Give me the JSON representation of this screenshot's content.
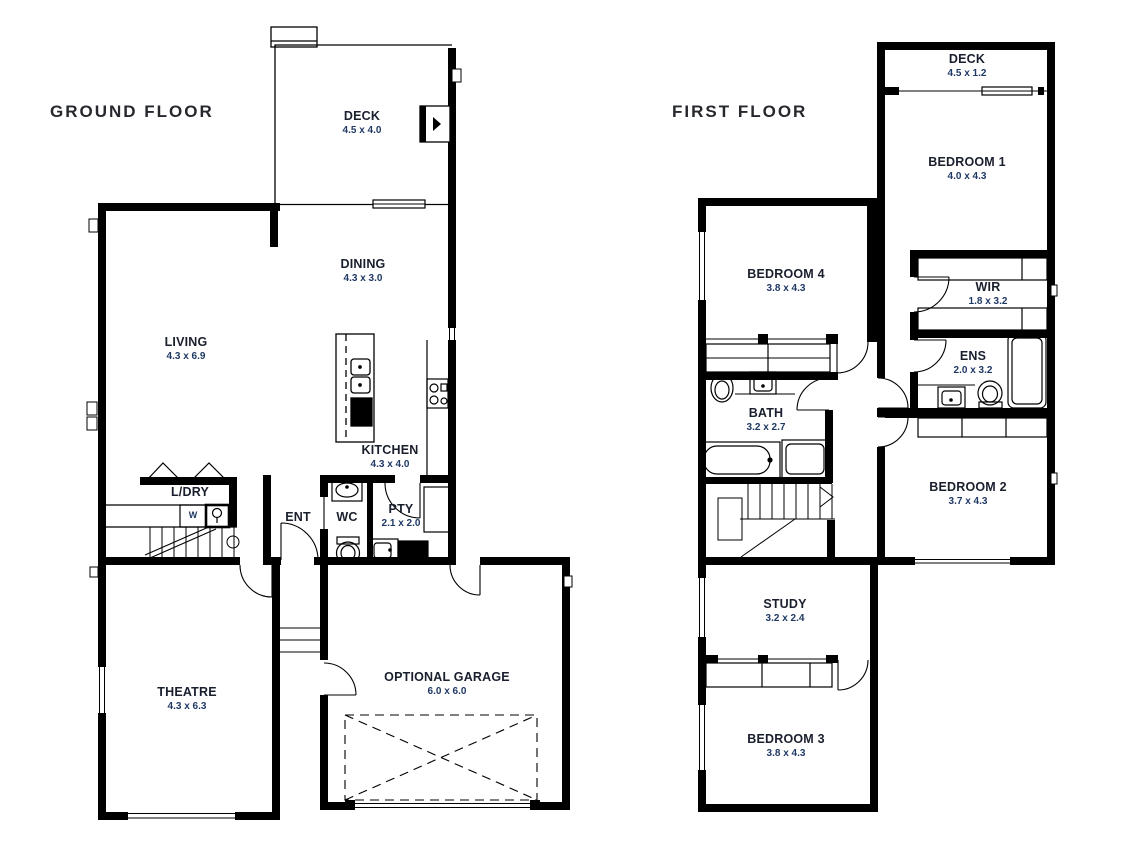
{
  "document_type": "house-floor-plan",
  "colors": {
    "wall": "#000000",
    "background": "#ffffff",
    "room_name_text": "#1a1f2e",
    "room_dims_text": "#1f3864",
    "title_text": "#26282e"
  },
  "floors": [
    {
      "id": "ground",
      "title": "GROUND FLOOR",
      "washer_label": "W",
      "rooms": [
        {
          "name": "DECK",
          "dims": "4.5 x 4.0"
        },
        {
          "name": "DINING",
          "dims": "4.3 x 3.0"
        },
        {
          "name": "LIVING",
          "dims": "4.3 x 6.9"
        },
        {
          "name": "KITCHEN",
          "dims": "4.3 x 4.0"
        },
        {
          "name": "L/DRY"
        },
        {
          "name": "ENT"
        },
        {
          "name": "WC"
        },
        {
          "name": "PTY",
          "dims": "2.1 x 2.0"
        },
        {
          "name": "THEATRE",
          "dims": "4.3 x 6.3"
        },
        {
          "name": "OPTIONAL GARAGE",
          "dims": "6.0 x 6.0"
        }
      ]
    },
    {
      "id": "first",
      "title": "FIRST FLOOR",
      "rooms": [
        {
          "name": "DECK",
          "dims": "4.5 x 1.2"
        },
        {
          "name": "BEDROOM 1",
          "dims": "4.0 x 4.3"
        },
        {
          "name": "BEDROOM 4",
          "dims": "3.8 x 4.3"
        },
        {
          "name": "WIR",
          "dims": "1.8 x 3.2"
        },
        {
          "name": "ENS",
          "dims": "2.0 x 3.2"
        },
        {
          "name": "BATH",
          "dims": "3.2 x 2.7"
        },
        {
          "name": "BEDROOM 2",
          "dims": "3.7 x 4.3"
        },
        {
          "name": "STUDY",
          "dims": "3.2 x 2.4"
        },
        {
          "name": "BEDROOM 3",
          "dims": "3.8 x 4.3"
        }
      ]
    }
  ]
}
